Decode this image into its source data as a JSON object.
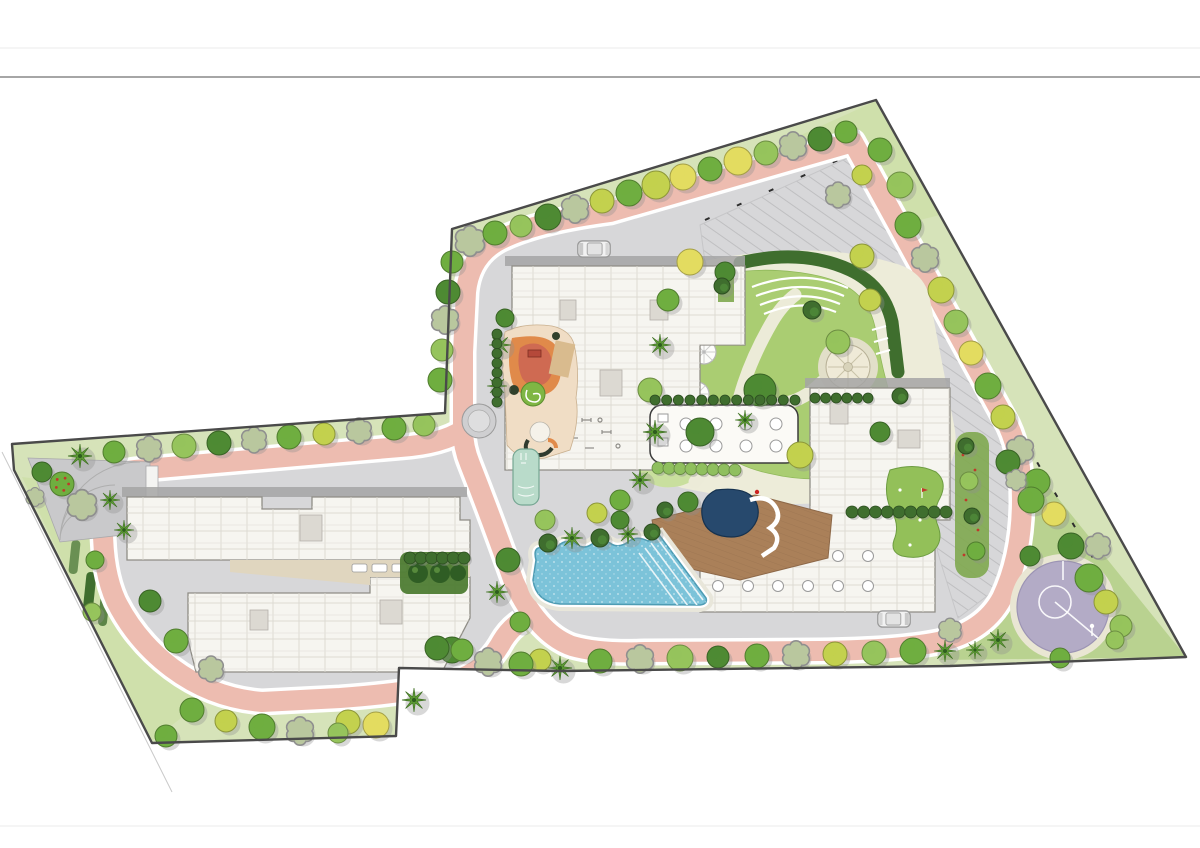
{
  "page": {
    "title": "residential-development-landscape-masterplan",
    "rules": {
      "top1_y": 48,
      "top2_y": 77,
      "bottom_y": 826
    }
  },
  "palette": {
    "boundary": "#4a4a4a",
    "band": "#d6e3b9",
    "band_light": "#cfe0ab",
    "se_green": "#b9d290",
    "lawn": "#aacd72",
    "lawn_light": "#c9df9e",
    "road_gray": "#d7d7d9",
    "road_pink": "#edbcb0",
    "curb_white": "#ffffff",
    "building_fill": "#f6f5f0",
    "building_line": "#8f8d86",
    "building_shadow": "#a5a5a5",
    "beige_walk": "#edecd9",
    "pool_blue": "#7cc3d9",
    "pool_edge": "#4e9cb4",
    "spa_navy": "#27496d",
    "deck_wood": "#aa8059",
    "court_purple": "#b3abc6",
    "tan_drive": "#e0d6bf",
    "plaza_gray": "#c9c9cb",
    "hedge_dark": "#3f6e2e",
    "sand": "#d9bb8e",
    "play_orange": "#e08a4a",
    "play_salmon": "#cf6a52",
    "putting_green": "#93c059",
    "kids_pool": "#b9dbca",
    "tree_colors": {
      "g1": "#4e8a33",
      "g2": "#6fae40",
      "g3": "#96c45c",
      "g4": "#c3d14e",
      "g5": "#e3dc60",
      "sage": "#b9c79e",
      "palm": "#5f9e35",
      "shrub": "#3f6e2e",
      "flower": "#6fae40"
    },
    "hedge_row": "#3f6e2e",
    "hedge_row_light": "#8fbf5e"
  },
  "landscape": {
    "trees": [
      [
        470,
        241,
        13,
        "sage"
      ],
      [
        495,
        233,
        12,
        "g2"
      ],
      [
        521,
        226,
        11,
        "g3"
      ],
      [
        548,
        217,
        13,
        "g1"
      ],
      [
        575,
        209,
        12,
        "sage"
      ],
      [
        602,
        201,
        12,
        "g4"
      ],
      [
        629,
        193,
        13,
        "g2"
      ],
      [
        656,
        185,
        14,
        "g4"
      ],
      [
        683,
        177,
        13,
        "g5"
      ],
      [
        710,
        169,
        12,
        "g2"
      ],
      [
        738,
        161,
        14,
        "g5"
      ],
      [
        766,
        153,
        12,
        "g3"
      ],
      [
        793,
        146,
        12,
        "sage"
      ],
      [
        820,
        139,
        12,
        "g1"
      ],
      [
        846,
        132,
        11,
        "g2"
      ],
      [
        880,
        150,
        12,
        "g2"
      ],
      [
        900,
        185,
        13,
        "g3"
      ],
      [
        862,
        175,
        10,
        "g4"
      ],
      [
        838,
        195,
        11,
        "sage"
      ],
      [
        452,
        262,
        11,
        "g2"
      ],
      [
        448,
        292,
        12,
        "g1"
      ],
      [
        445,
        320,
        12,
        "sage"
      ],
      [
        442,
        350,
        11,
        "g3"
      ],
      [
        440,
        380,
        12,
        "g2"
      ],
      [
        908,
        225,
        13,
        "g2"
      ],
      [
        925,
        258,
        12,
        "sage"
      ],
      [
        941,
        290,
        13,
        "g4"
      ],
      [
        956,
        322,
        12,
        "g3"
      ],
      [
        971,
        353,
        12,
        "g5"
      ],
      [
        988,
        386,
        13,
        "g2"
      ],
      [
        1003,
        417,
        12,
        "g4"
      ],
      [
        1020,
        450,
        12,
        "sage"
      ],
      [
        1037,
        482,
        13,
        "g2"
      ],
      [
        1054,
        514,
        12,
        "g5"
      ],
      [
        1071,
        546,
        13,
        "g1"
      ],
      [
        1089,
        578,
        14,
        "g2"
      ],
      [
        1106,
        602,
        12,
        "g4"
      ],
      [
        1121,
        626,
        11,
        "g3"
      ],
      [
        1008,
        462,
        12,
        "g1"
      ],
      [
        1031,
        500,
        13,
        "g2"
      ],
      [
        1016,
        480,
        9,
        "sage"
      ],
      [
        1098,
        546,
        11,
        "sage"
      ],
      [
        1030,
        556,
        10,
        "g1"
      ],
      [
        998,
        640,
        11,
        "palm"
      ],
      [
        975,
        650,
        9,
        "palm"
      ],
      [
        1060,
        658,
        10,
        "g2"
      ],
      [
        1115,
        640,
        9,
        "g3"
      ],
      [
        950,
        630,
        10,
        "sage"
      ],
      [
        600,
        661,
        12,
        "g2"
      ],
      [
        640,
        659,
        12,
        "sage"
      ],
      [
        680,
        658,
        13,
        "g3"
      ],
      [
        718,
        657,
        11,
        "g1"
      ],
      [
        757,
        656,
        12,
        "g2"
      ],
      [
        796,
        655,
        12,
        "sage"
      ],
      [
        835,
        654,
        12,
        "g4"
      ],
      [
        874,
        653,
        12,
        "g3"
      ],
      [
        913,
        651,
        13,
        "g2"
      ],
      [
        945,
        651,
        11,
        "palm"
      ],
      [
        560,
        668,
        12,
        "palm"
      ],
      [
        540,
        660,
        11,
        "g4"
      ],
      [
        521,
        664,
        12,
        "g2"
      ],
      [
        488,
        662,
        12,
        "sage"
      ],
      [
        452,
        650,
        13,
        "g1"
      ],
      [
        437,
        648,
        12,
        "g1"
      ],
      [
        462,
        650,
        11,
        "g2"
      ],
      [
        414,
        700,
        12,
        "palm"
      ],
      [
        376,
        725,
        13,
        "g5"
      ],
      [
        348,
        722,
        12,
        "g4"
      ],
      [
        338,
        733,
        10,
        "g3"
      ],
      [
        300,
        731,
        12,
        "sage"
      ],
      [
        262,
        727,
        13,
        "g2"
      ],
      [
        226,
        721,
        11,
        "g4"
      ],
      [
        192,
        710,
        12,
        "g2"
      ],
      [
        166,
        736,
        11,
        "g2"
      ],
      [
        80,
        456,
        12,
        "palm"
      ],
      [
        114,
        452,
        11,
        "g2"
      ],
      [
        149,
        449,
        11,
        "sage"
      ],
      [
        184,
        446,
        12,
        "g3"
      ],
      [
        219,
        443,
        12,
        "g1"
      ],
      [
        254,
        440,
        11,
        "sage"
      ],
      [
        289,
        437,
        12,
        "g2"
      ],
      [
        324,
        434,
        11,
        "g4"
      ],
      [
        359,
        431,
        11,
        "sage"
      ],
      [
        394,
        428,
        12,
        "g2"
      ],
      [
        424,
        425,
        11,
        "g3"
      ],
      [
        42,
        472,
        10,
        "g1"
      ],
      [
        62,
        484,
        12,
        "flower"
      ],
      [
        82,
        505,
        13,
        "sage"
      ],
      [
        110,
        500,
        10,
        "palm"
      ],
      [
        35,
        497,
        8,
        "sage"
      ],
      [
        124,
        530,
        10,
        "palm"
      ],
      [
        150,
        601,
        11,
        "g1"
      ],
      [
        176,
        641,
        12,
        "g2"
      ],
      [
        211,
        669,
        11,
        "sage"
      ],
      [
        95,
        560,
        9,
        "g2"
      ],
      [
        92,
        612,
        9,
        "g3"
      ],
      [
        668,
        300,
        11,
        "g2"
      ],
      [
        660,
        345,
        11,
        "palm"
      ],
      [
        650,
        390,
        12,
        "g3"
      ],
      [
        655,
        432,
        12,
        "palm"
      ],
      [
        700,
        432,
        14,
        "g1"
      ],
      [
        745,
        420,
        10,
        "palm"
      ],
      [
        760,
        390,
        16,
        "g1"
      ],
      [
        800,
        455,
        13,
        "g4"
      ],
      [
        838,
        342,
        12,
        "g3"
      ],
      [
        870,
        300,
        11,
        "g4"
      ],
      [
        862,
        256,
        12,
        "g4"
      ],
      [
        690,
        262,
        13,
        "g5"
      ],
      [
        725,
        272,
        10,
        "g1"
      ],
      [
        880,
        432,
        10,
        "g1"
      ],
      [
        900,
        396,
        8,
        "shrub"
      ],
      [
        812,
        310,
        9,
        "shrub"
      ],
      [
        640,
        480,
        11,
        "palm"
      ],
      [
        620,
        500,
        10,
        "g2"
      ],
      [
        688,
        502,
        10,
        "g1"
      ],
      [
        665,
        510,
        8,
        "shrub"
      ],
      [
        548,
        543,
        9,
        "shrub"
      ],
      [
        572,
        538,
        11,
        "palm"
      ],
      [
        600,
        538,
        9,
        "shrub"
      ],
      [
        628,
        534,
        10,
        "palm"
      ],
      [
        652,
        532,
        8,
        "shrub"
      ],
      [
        545,
        520,
        10,
        "g3"
      ],
      [
        597,
        513,
        10,
        "g4"
      ],
      [
        620,
        520,
        9,
        "g1"
      ],
      [
        508,
        560,
        12,
        "g1"
      ],
      [
        497,
        592,
        11,
        "palm"
      ],
      [
        520,
        622,
        10,
        "g2"
      ],
      [
        500,
        345,
        11,
        "palm"
      ],
      [
        497,
        386,
        10,
        "palm"
      ],
      [
        505,
        318,
        9,
        "g1"
      ],
      [
        966,
        446,
        8,
        "shrub"
      ],
      [
        969,
        481,
        9,
        "g3"
      ],
      [
        972,
        516,
        8,
        "shrub"
      ],
      [
        976,
        551,
        9,
        "g2"
      ],
      [
        722,
        286,
        8,
        "shrub"
      ]
    ],
    "hedge_rows": [
      {
        "x1": 655,
        "y1": 400,
        "x2": 795,
        "y2": 400,
        "n": 13,
        "r": 5,
        "k": "dark"
      },
      {
        "x1": 658,
        "y1": 468,
        "x2": 735,
        "y2": 470,
        "n": 8,
        "r": 6,
        "k": "light"
      },
      {
        "x1": 815,
        "y1": 398,
        "x2": 868,
        "y2": 398,
        "n": 6,
        "r": 5,
        "k": "dark"
      },
      {
        "x1": 410,
        "y1": 558,
        "x2": 464,
        "y2": 558,
        "n": 6,
        "r": 6,
        "k": "dark"
      },
      {
        "x1": 497,
        "y1": 334,
        "x2": 497,
        "y2": 402,
        "n": 8,
        "r": 5,
        "k": "dark"
      },
      {
        "x1": 852,
        "y1": 512,
        "x2": 946,
        "y2": 512,
        "n": 9,
        "r": 6,
        "k": "dark"
      }
    ]
  },
  "vehicles": [
    {
      "x": 594,
      "y": 249,
      "rot": 180
    },
    {
      "x": 894,
      "y": 619,
      "rot": 0
    }
  ],
  "features": {
    "site": "gated residential parcel with perimeter loop road",
    "pool": "freeform lagoon swimming pool with deck steps",
    "spa": "dark plunge spa with slide",
    "court": "circular purple multi-play court",
    "playground": "organic kids play area",
    "mandala": "circular paved garden",
    "amphitheater": "curved lawn steps",
    "parking": "surface parking with diagonal stalls"
  }
}
